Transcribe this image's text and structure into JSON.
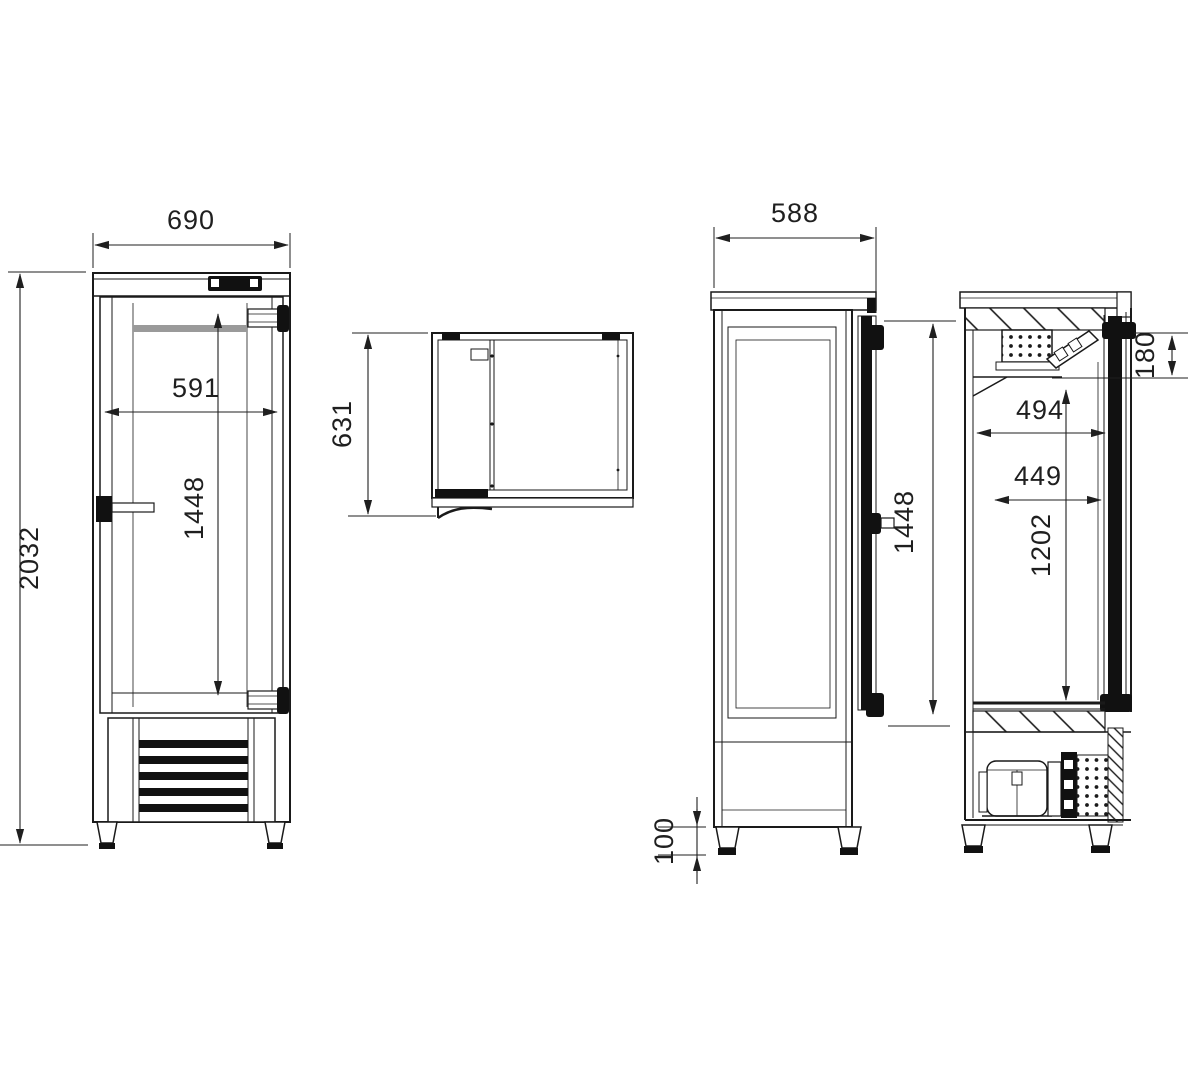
{
  "drawing": {
    "type": "technical-dimension-drawing",
    "subject": "single-door upright refrigerated cabinet",
    "units": "mm",
    "colors": {
      "line": "#1a1a1a",
      "background": "#ffffff",
      "door_band_gray": "#9a9a9a"
    },
    "views": {
      "front": {
        "label": "front view",
        "dimensions": {
          "overall_width": "690",
          "overall_height": "2032",
          "door_width": "591",
          "door_height": "1448"
        }
      },
      "top": {
        "label": "top view",
        "dimensions": {
          "depth_with_handle": "631"
        }
      },
      "side": {
        "label": "side view",
        "dimensions": {
          "depth": "588",
          "foot_height": "100",
          "door_height": "1448"
        }
      },
      "section": {
        "label": "cross section",
        "dimensions": {
          "evaporator_zone_height": "180",
          "interior_depth_upper": "494",
          "interior_depth_lower": "449",
          "interior_height": "1202"
        }
      }
    }
  }
}
